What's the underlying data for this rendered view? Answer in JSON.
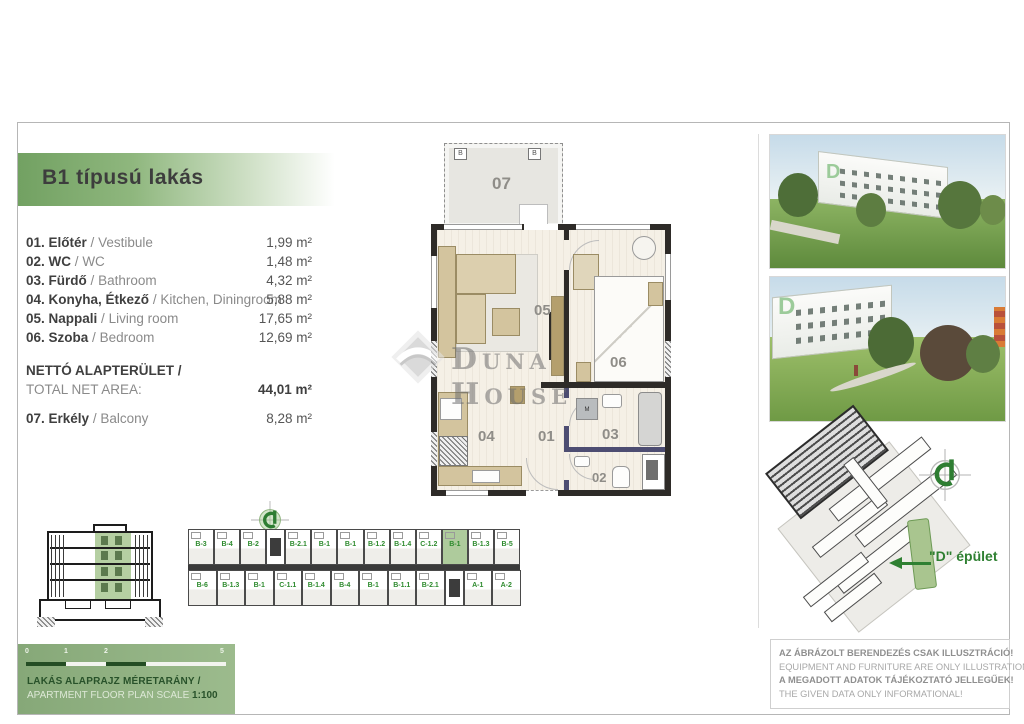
{
  "header": {
    "title": "B1 típusú lakás"
  },
  "room_list": {
    "separator": "/",
    "rooms": [
      {
        "label_hu": "01. Előtér",
        "label_en": "Vestibule",
        "area": "1,99 m²"
      },
      {
        "label_hu": "02. WC",
        "label_en": "WC",
        "area": "1,48 m²"
      },
      {
        "label_hu": "03. Fürdő",
        "label_en": "Bathroom",
        "area": "4,32 m²"
      },
      {
        "label_hu": "04. Konyha, Étkező",
        "label_en": "Kitchen, Diningroom",
        "area": "5,88 m²"
      },
      {
        "label_hu": "05. Nappali",
        "label_en": "Living room",
        "area": "17,65 m²"
      },
      {
        "label_hu": "06. Szoba",
        "label_en": "Bedroom",
        "area": "12,69 m²"
      }
    ],
    "total": {
      "label_hu": "NETTÓ ALAPTERÜLET /",
      "label_en": "TOTAL NET AREA:",
      "area": "44,01 m²"
    },
    "balcony": {
      "label_hu": "07. Erkély",
      "label_en": "Balcony",
      "area": "8,28 m²"
    }
  },
  "floor_plan": {
    "numbers": {
      "vestibule": "01",
      "wc": "02",
      "bathroom": "03",
      "kitchen": "04",
      "living": "05",
      "bedroom": "06",
      "balcony": "07"
    },
    "marker_b": "B",
    "washer_label": "M",
    "watermark_text": "Duna House"
  },
  "photos": {
    "d_label": "D"
  },
  "overview_strip": {
    "top_row": [
      "B-3",
      "B-4",
      "B-2",
      "B-2.1",
      "B-1",
      "B-1",
      "B-1.2",
      "B-1.4",
      "C-1.2",
      "B-1",
      "B-1.3",
      "B-5"
    ],
    "bottom_row": [
      "B-6",
      "B-1.3",
      "B-1",
      "C-1.1",
      "B-1.4",
      "B-4",
      "B-1",
      "B-1.1",
      "B-2.1",
      "A-1",
      "A-2"
    ],
    "highlighted_unit": "B-1"
  },
  "site_plan": {
    "building_label": "\"D\" épület"
  },
  "scale_bar": {
    "ticks": [
      "0",
      "1",
      "2",
      "5"
    ],
    "title_hu": "LAKÁS ALAPRAJZ MÉRETARÁNY /",
    "title_en": "APARTMENT FLOOR PLAN SCALE",
    "scale_value": "1:100"
  },
  "disclaimer": {
    "lines": [
      "AZ ÁBRÁZOLT BERENDEZÉS CSAK ILLUSZTRÁCIÓ!",
      "EQUIPMENT AND FURNITURE ARE ONLY ILLUSTRATION!",
      "A MEGADOTT ADATOK TÁJÉKOZTATÓ JELLEGŰEK!",
      "THE GIVEN DATA ONLY INFORMATIONAL!"
    ]
  },
  "colors": {
    "accent_green": "#72a162",
    "highlight_green": "#aecb9c",
    "unit_label_green": "#2e8b2e",
    "site_label_green": "#2f8032",
    "wall_black": "#2e2b28",
    "furniture_tan": "#d3c49e"
  }
}
